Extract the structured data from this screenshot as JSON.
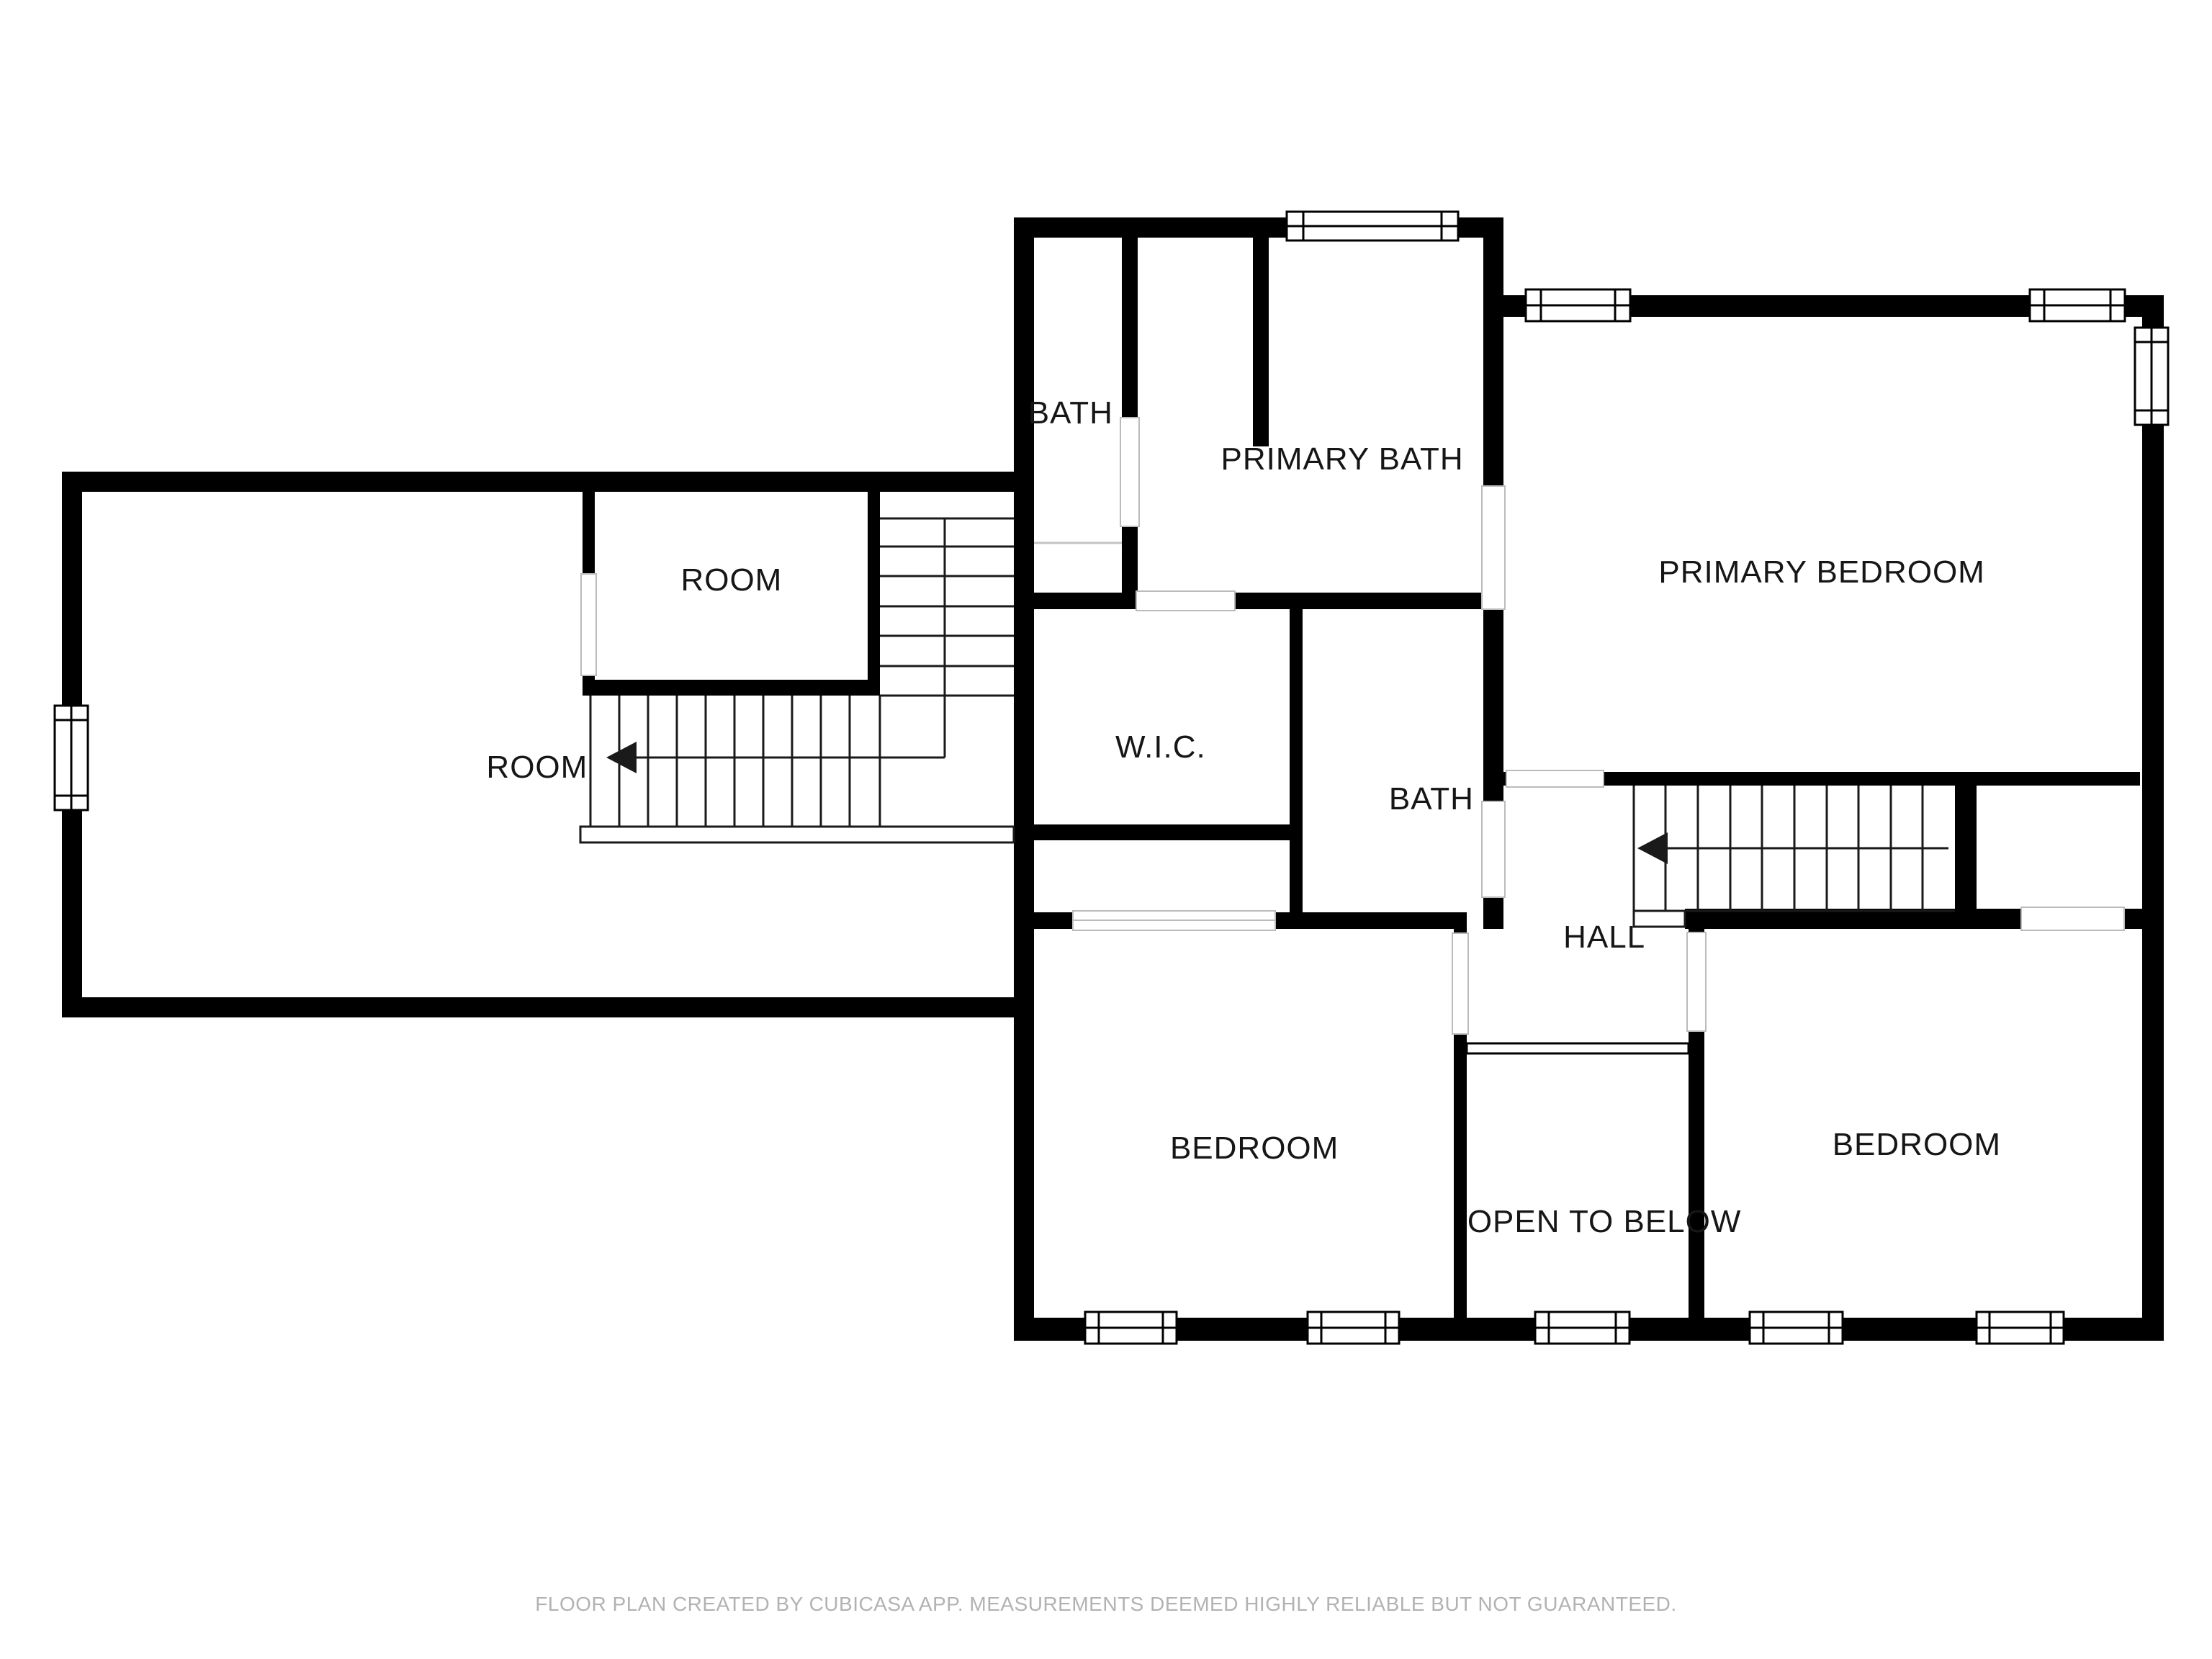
{
  "meta": {
    "type": "floor-plan",
    "creator_note_visible": true
  },
  "colors": {
    "wall": "#000000",
    "background": "#ffffff",
    "stair_line": "#1a1a1a",
    "door_opening_line": "#bbbbbb",
    "fixture_line": "#c4c4c4",
    "label_text": "#161616",
    "footer_text": "#b2b2b2"
  },
  "rooms": [
    {
      "id": "bath-top",
      "label": "BATH"
    },
    {
      "id": "primary-bath",
      "label": "PRIMARY BATH"
    },
    {
      "id": "primary-bedroom",
      "label": "PRIMARY BEDROOM"
    },
    {
      "id": "room-inner",
      "label": "ROOM"
    },
    {
      "id": "room-left",
      "label": "ROOM"
    },
    {
      "id": "wic",
      "label": "W.I.C."
    },
    {
      "id": "bath-center",
      "label": "BATH"
    },
    {
      "id": "hall",
      "label": "HALL"
    },
    {
      "id": "bedroom-left",
      "label": "BEDROOM"
    },
    {
      "id": "open-to-below",
      "label": "OPEN TO BELOW"
    },
    {
      "id": "bedroom-right",
      "label": "BEDROOM"
    }
  ],
  "stairs": [
    {
      "id": "left-staircase",
      "icon": "left-arrow-icon",
      "direction": "left"
    },
    {
      "id": "hall-staircase",
      "icon": "left-arrow-icon",
      "direction": "left"
    }
  ],
  "footer": {
    "text": "FLOOR PLAN CREATED BY CUBICASA APP. MEASUREMENTS DEEMED HIGHLY RELIABLE BUT NOT GUARANTEED."
  }
}
